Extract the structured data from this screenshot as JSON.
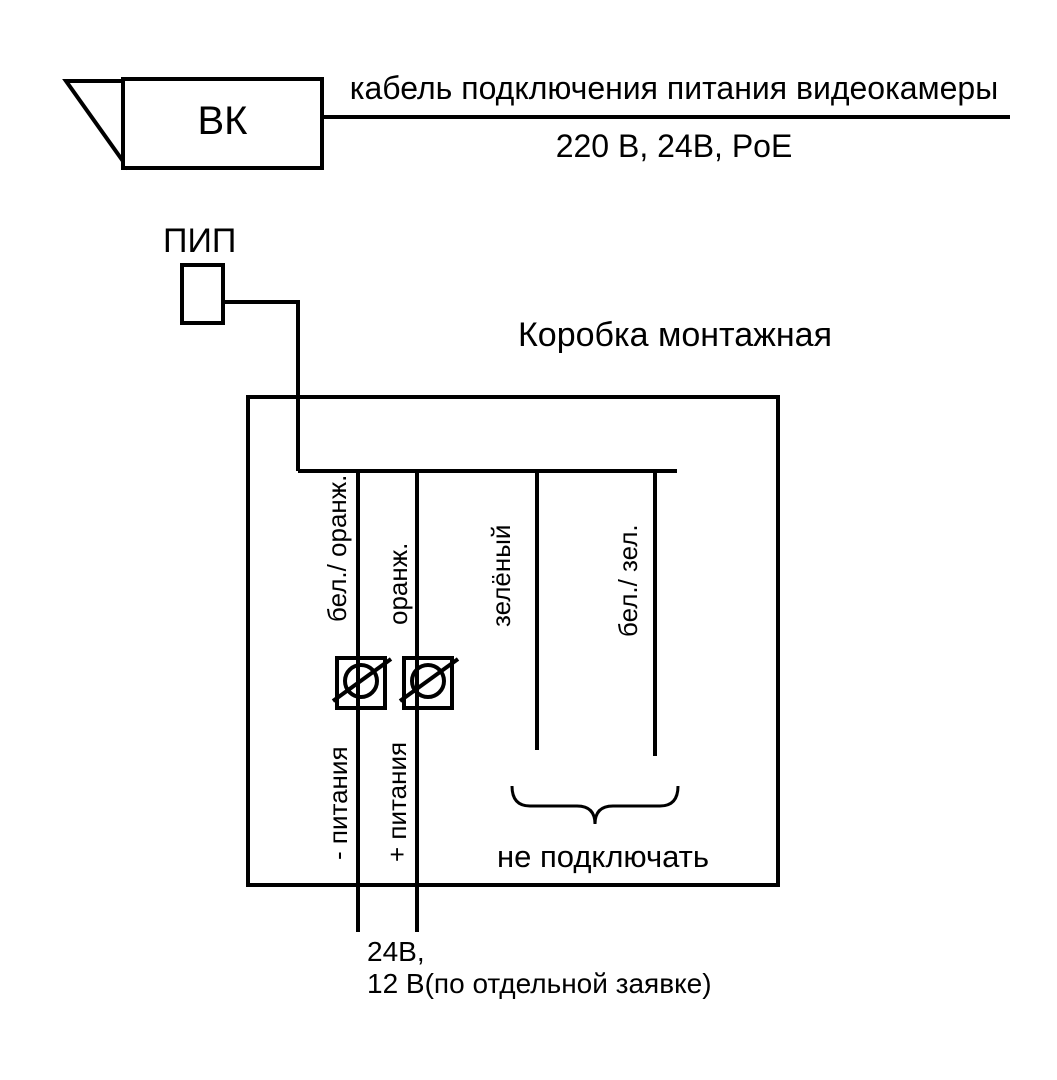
{
  "diagram": {
    "background": "#ffffff",
    "line_color": "#000000",
    "camera": {
      "label": "ВК"
    },
    "cable": {
      "label": "кабель подключения питания видеокамеры",
      "voltages": "220 В, 24В, PoE"
    },
    "pip": {
      "label": "ПИП"
    },
    "junction_box": {
      "title": "Коробка монтажная"
    },
    "wires": [
      {
        "color_label": "бел./ оранж.",
        "function_label": "- питания"
      },
      {
        "color_label": "оранж.",
        "function_label": "+ питания"
      },
      {
        "color_label": "зелёный"
      },
      {
        "color_label": "бел./ зел."
      }
    ],
    "do_not_connect_label": "не подключать",
    "power_note": {
      "line1": "24В,",
      "line2": "12 В(по отдельной заявке)"
    }
  }
}
